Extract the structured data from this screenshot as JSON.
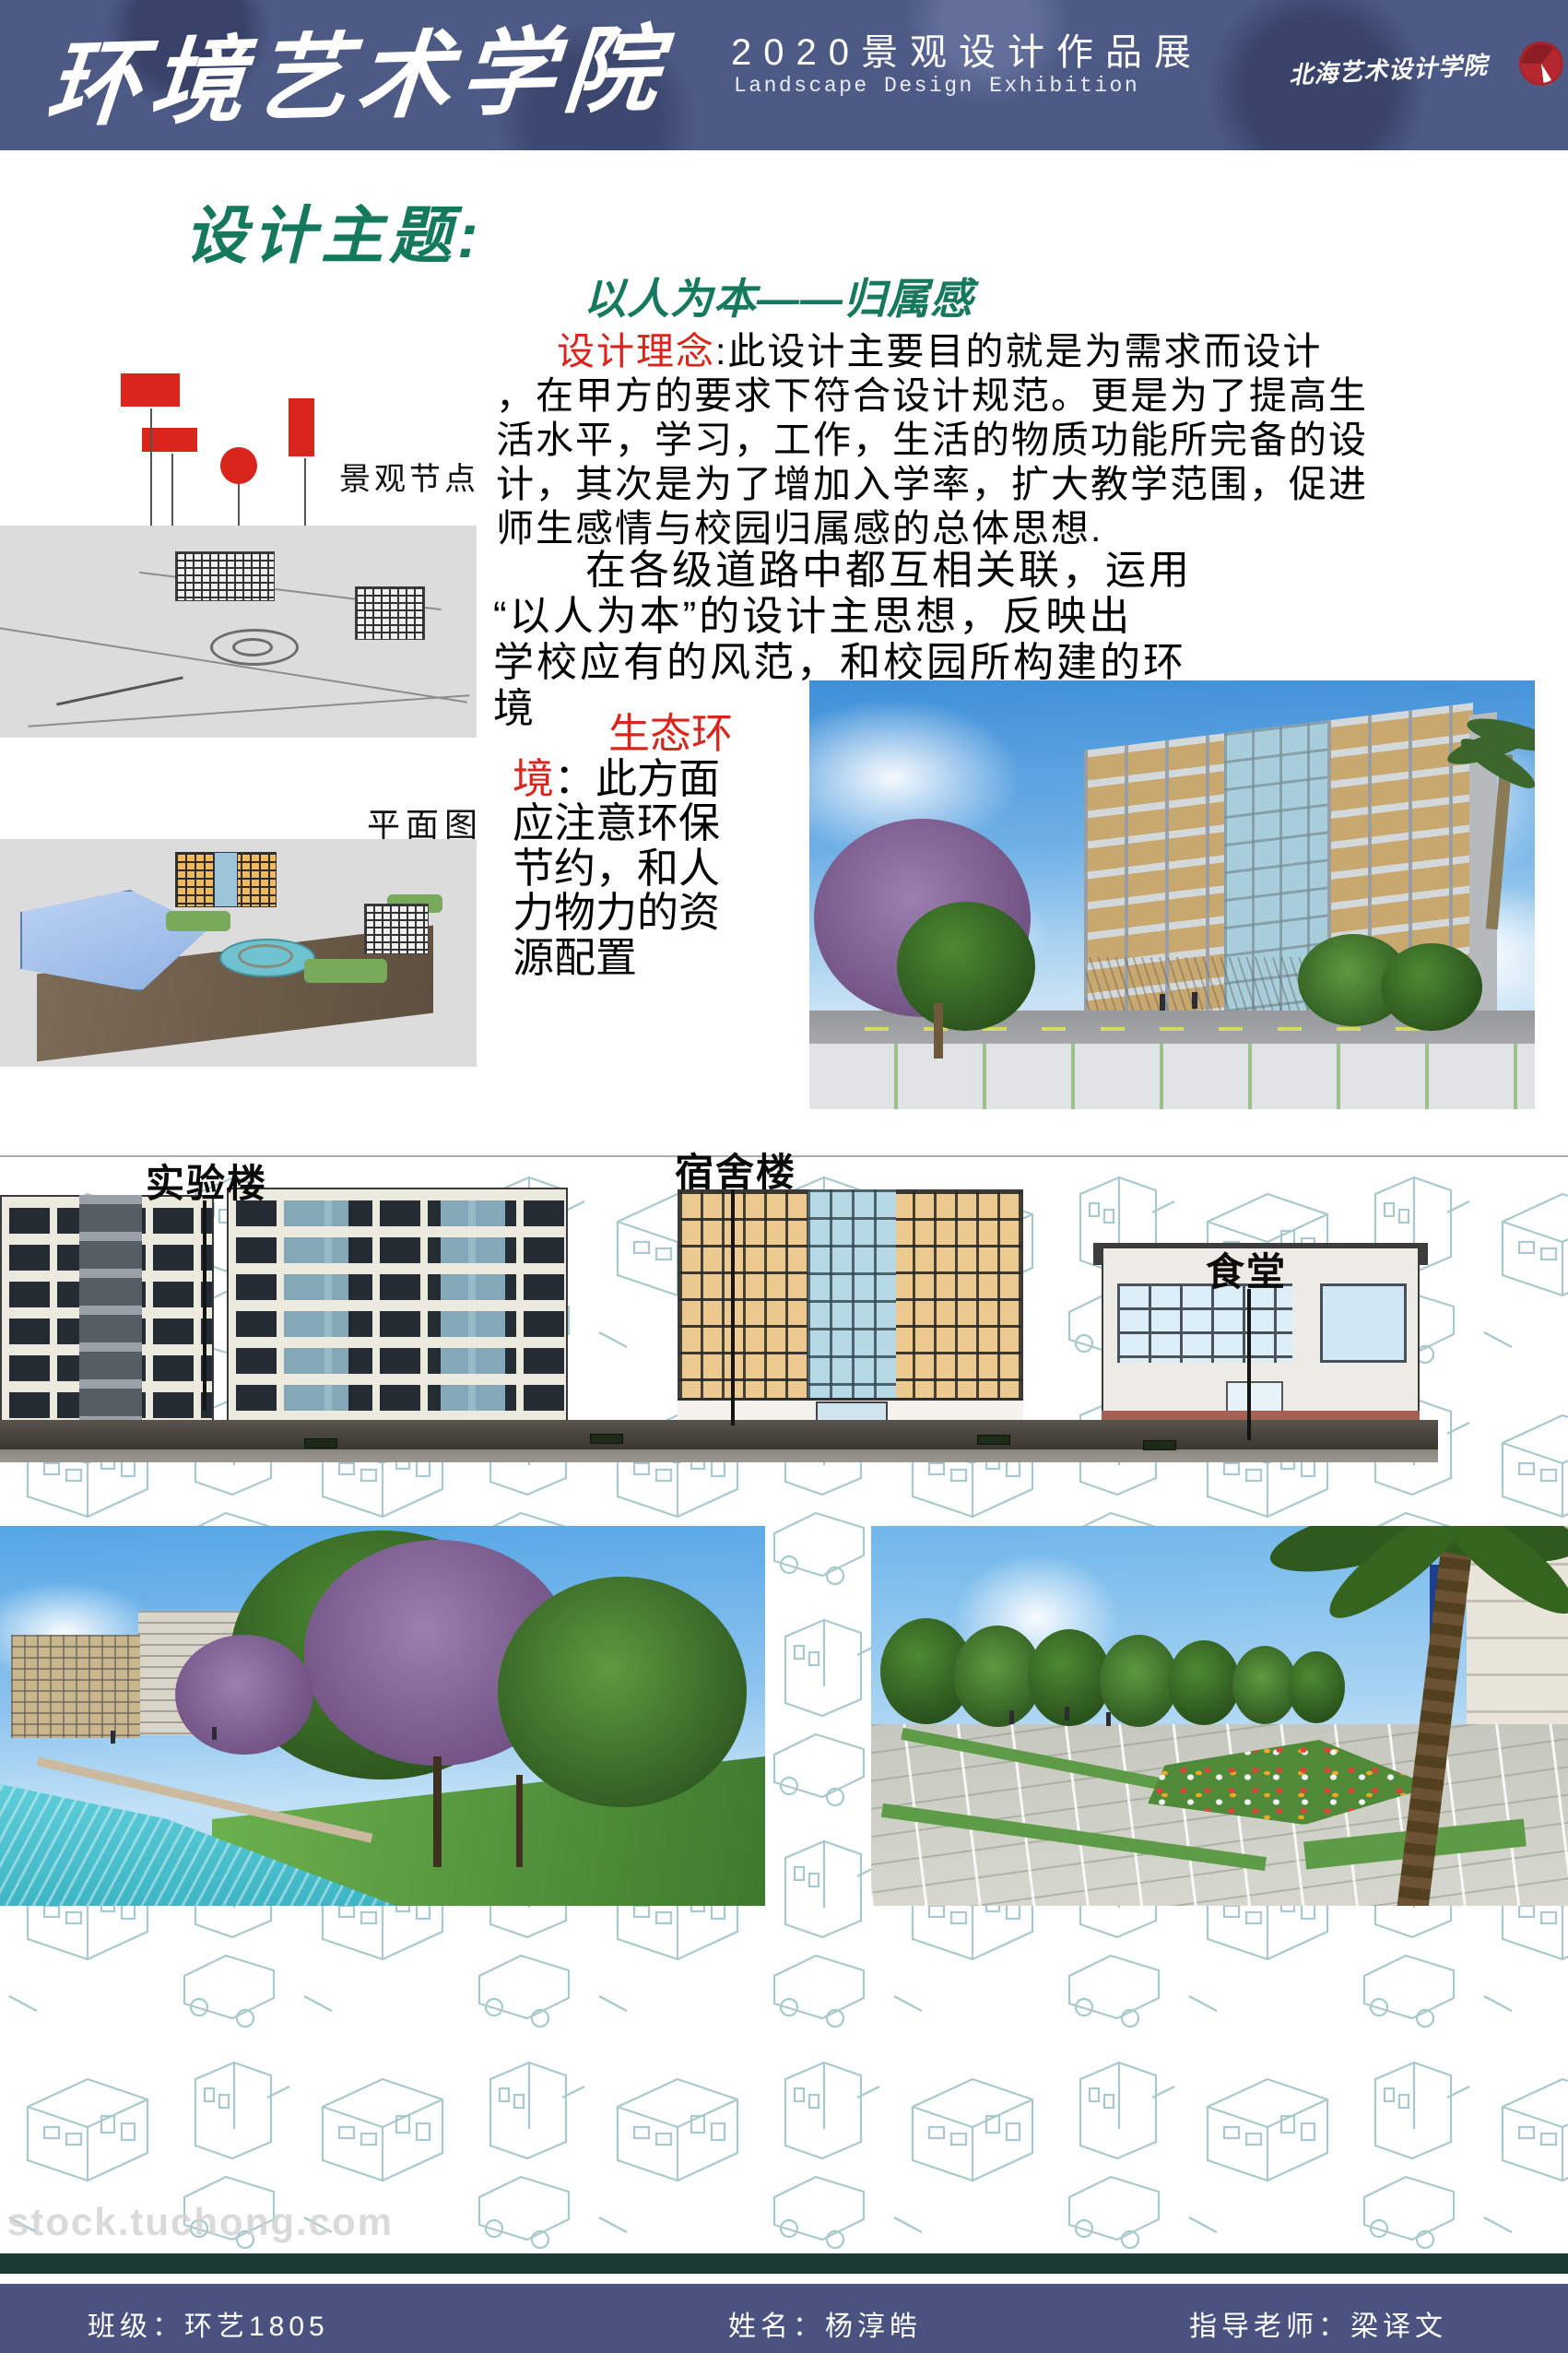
{
  "colors": {
    "header-bg": "#4d5a85",
    "footer-bg": "#4a5380",
    "accent-red": "#d9251c",
    "heading-green": "#157a5d",
    "sketch-teal": "#5f9ba1",
    "divider-teal": "#1c3a34"
  },
  "header": {
    "school_name": "环境艺术学院",
    "exhibition_title_cn": "2020景观设计作品展",
    "exhibition_title_en": "Landscape Design Exhibition",
    "logo_text": "北海艺术设计学院"
  },
  "theme": {
    "heading": "设计主题:",
    "subtitle": "以人为本——归属感"
  },
  "concept": {
    "label": "设计理念",
    "text": ":此设计主要目的就是为需求而设计\n，在甲方的要求下符合设计规范。更是为了提高生\n活水平，学习，工作，生活的物质功能所完备的设\n计，其次是为了增加入学率，扩大教学范围，促进\n师生感情与校园归属感的总体思想."
  },
  "roads": {
    "text": "在各级道路中都互相关联，运用\n“以人为本”的设计主思想，反映出\n学校应有的风范，和校园所构建的环\n境"
  },
  "ecology": {
    "label": "生态环\n境",
    "text": "：此方面\n应注意环保\n节约，和人\n力物力的资\n源配置"
  },
  "inspiration": {
    "label": "灵感来源",
    "text": "：来自于形状上对人的影响\n以圆形为主的水面平台良好的沟通了四通\n八达的路。有汇集的功能也具有疏散的功\n能，形式虽然有些单一，但是其中蕴含了\n简洁所带来的便利性，实用性。"
  },
  "annotations": {
    "landscape_node": "景观节点",
    "plan_view": "平面图",
    "lab_building": "实验楼",
    "dormitory": "宿舍楼",
    "canteen": "食堂"
  },
  "watermark": "stock.tuchong.com",
  "footer": {
    "class_label": "班级：环艺1805",
    "name_label": "姓名：杨淳皓",
    "teacher_label": "指导老师：梁译文"
  }
}
